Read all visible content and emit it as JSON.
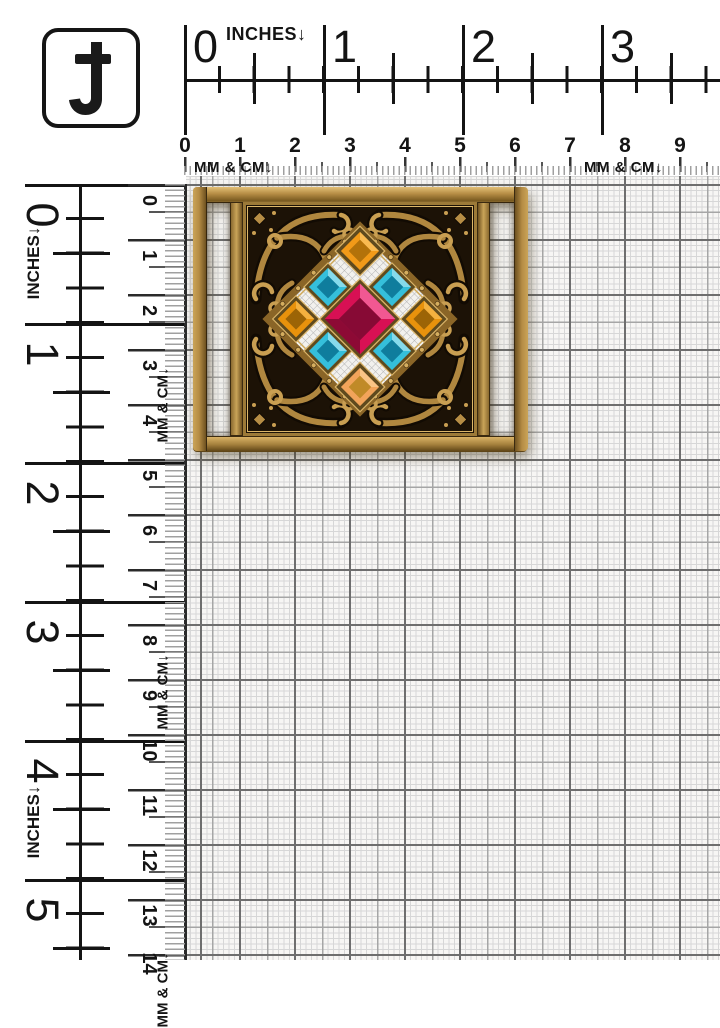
{
  "logo": {
    "glyph": "J"
  },
  "rulers": {
    "top_inches": {
      "label": "INCHES↓",
      "numbers": [
        "0",
        "1",
        "2",
        "3"
      ]
    },
    "top_mm_cm": {
      "label_left": "MM & CM↓",
      "label_right": "MM & CM↓",
      "numbers": [
        "0",
        "1",
        "2",
        "3",
        "4",
        "5",
        "6",
        "7",
        "8",
        "9"
      ]
    },
    "left_inches": {
      "label_upper": "INCHES↓",
      "label_lower": "INCHES↓",
      "numbers": [
        "0",
        "1",
        "2",
        "3",
        "4",
        "5"
      ]
    },
    "left_mm_cm": {
      "label_upper": "MM & CM↓",
      "label_middle": "MM & CM↓",
      "label_bottom": "MM & CM↓",
      "numbers": [
        "0",
        "1",
        "2",
        "3",
        "4",
        "5",
        "6",
        "7",
        "8",
        "9",
        "10",
        "11",
        "12",
        "13",
        "14"
      ]
    }
  },
  "product": {
    "description": "Antique gold ornate filigree rectangular belt buckle with multicolor square rhinestones on mm grid background",
    "colors": {
      "brass_light": "#e3c077",
      "brass_mid": "#b68d45",
      "brass_dark": "#6e5120",
      "panel_bg": "#1c1206",
      "scroll_gold": "#b0873f",
      "scroll_highlight": "#e2c27a",
      "bezel_gold": "#d9b266",
      "gem_center": "#d81054",
      "gem_center_dark": "#870a35",
      "gem_center_light": "#ff7fb4",
      "gem_teal": "#35bfdb",
      "gem_teal_dark": "#0f7d9d",
      "gem_orange": "#f29a18",
      "gem_orange_dark": "#b3720a",
      "gem_side_orange": "#e8920c",
      "gem_side_orange_dark": "#9c6406",
      "gem_bottom_orange": "#f2a45a",
      "gem_bottom_orange_dark": "#c08a28"
    }
  },
  "grid": {
    "fine": "#d7d7d7",
    "medium": "#a6a6a6",
    "bold": "#6e6e6e"
  }
}
